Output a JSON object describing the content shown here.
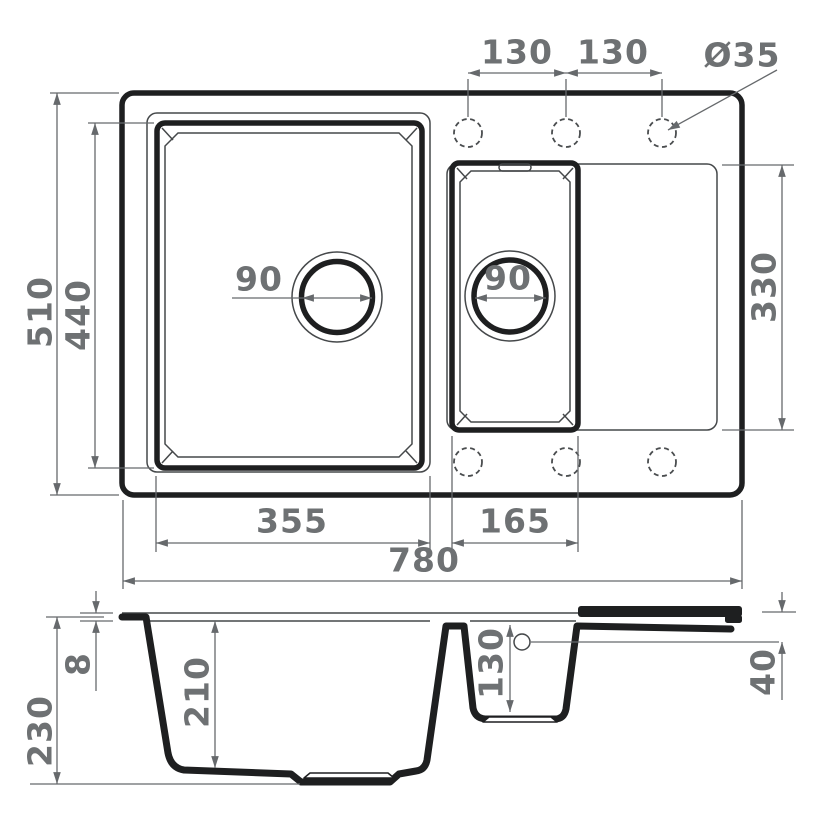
{
  "colors": {
    "outline": "#1e1f20",
    "thin_line": "#45484a",
    "dimension_line": "#66696c",
    "dimension_text": "#6e7173",
    "background": "#ffffff"
  },
  "top_view": {
    "dims": {
      "overall_width": "780",
      "overall_depth": "510",
      "main_bowl_width": "355",
      "main_bowl_depth": "440",
      "half_bowl_width": "165",
      "drainboard_depth": "330",
      "tap_hole_spacing_left": "130",
      "tap_hole_spacing_right": "130",
      "tap_hole_diameter": "Ø35",
      "main_drain_diameter": "90",
      "half_drain_diameter": "90"
    }
  },
  "section_view": {
    "dims": {
      "overall_height": "230",
      "rim_thickness": "8",
      "main_bowl_depth": "210",
      "half_bowl_depth": "130",
      "drainboard_edge_height": "40"
    }
  }
}
